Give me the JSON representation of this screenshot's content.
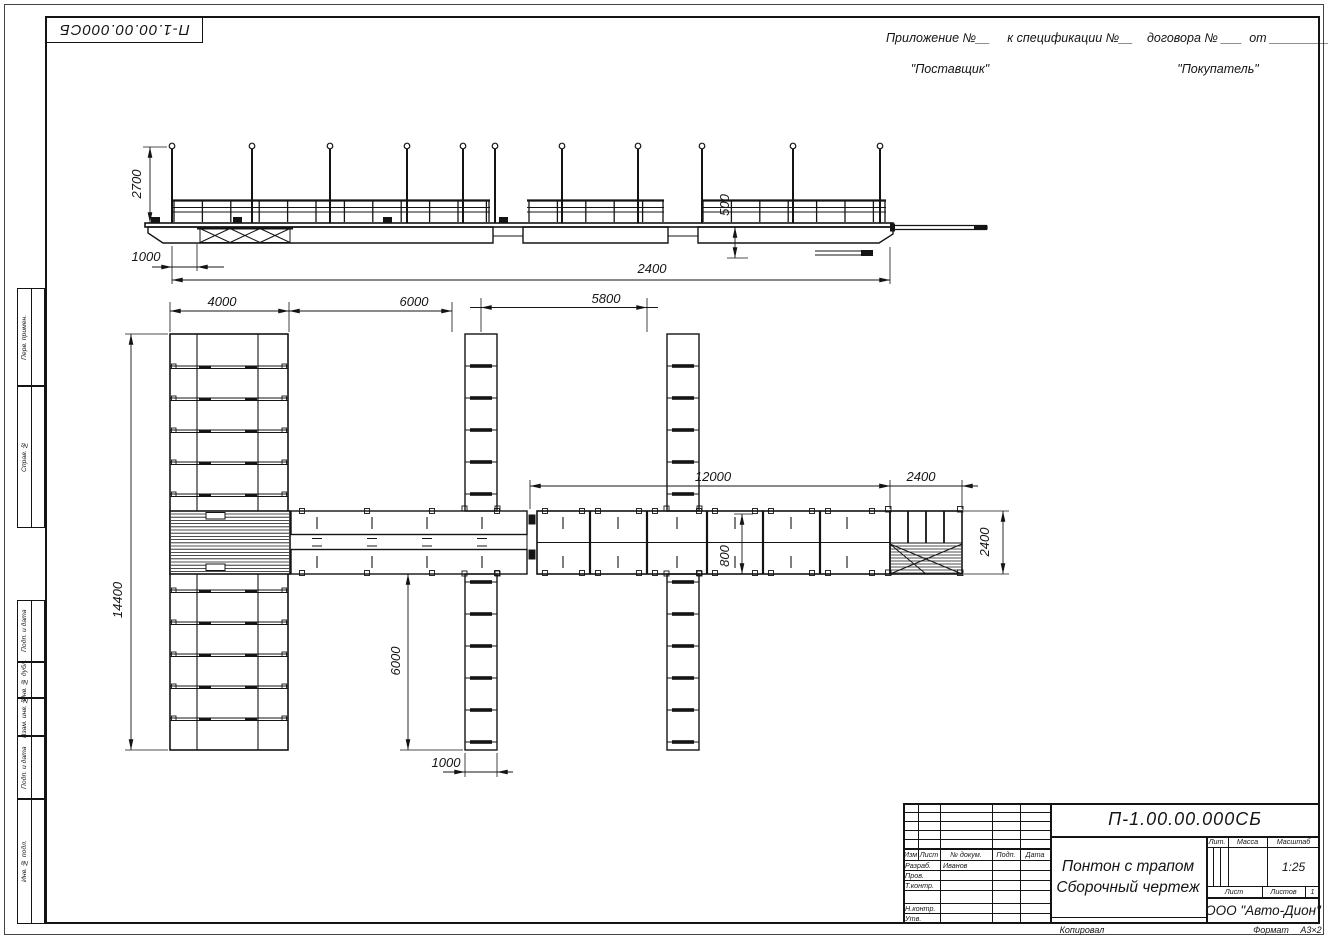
{
  "stamp": {
    "doc_number": "П-1.00.00.000СБ"
  },
  "appendix": {
    "line": "Приложение №__     к спецификации №__    договора № ___  от _________",
    "supplier": "\"Поставщик\"",
    "buyer": "\"Покупатель\""
  },
  "margin_columns": {
    "perv_primen": "Перв. примен.",
    "sprav_no": "Справ. №",
    "podp_i_data_1": "Подп. и дата",
    "inv_no_dubl": "Инв. № дубл.",
    "vzam_inv_no": "Взам. инв. №",
    "podp_i_data_2": "Подп. и дата",
    "inv_no_podl": "Инв. № подл."
  },
  "title_block": {
    "doc_number": "П-1.00.00.000СБ",
    "title_line1": "Понтон с трапом",
    "title_line2": "Сборочный чертеж",
    "organization": "ООО \"Авто-Дион\"",
    "scale_value": "1:25",
    "sheet_total": "1",
    "headers": {
      "izm": "Изм",
      "list": "Лист",
      "dokum": "№ докум.",
      "podp": "Подп.",
      "data": "Дата",
      "lit": "Лит.",
      "massa": "Масса",
      "masshtab": "Масштаб",
      "list_small": "Лист",
      "listov": "Листов"
    },
    "signature_rows": [
      {
        "label": "Разраб.",
        "name": "Иванов"
      },
      {
        "label": "Пров.",
        "name": ""
      },
      {
        "label": "Т.контр.",
        "name": ""
      },
      {
        "label": "",
        "name": ""
      },
      {
        "label": "Н.контр.",
        "name": ""
      },
      {
        "label": "Утв.",
        "name": ""
      }
    ]
  },
  "footer": {
    "copied": "Копировал",
    "format_label": "Формат",
    "format_value": "А3×2"
  },
  "dimensions": {
    "side_view": {
      "mast_height": "2700",
      "left_offset": "1000",
      "freeboard": "500",
      "pontoon_length": "2400"
    },
    "plan_view": {
      "bay_1": "4000",
      "bay_2": "6000",
      "bay_3": "5800",
      "walkway_length": "12000",
      "gangway_length": "2400",
      "overall_width": "14400",
      "finger_length": "6000",
      "finger_width": "1000",
      "walkway_width": "800",
      "gangway_width": "2400"
    }
  }
}
